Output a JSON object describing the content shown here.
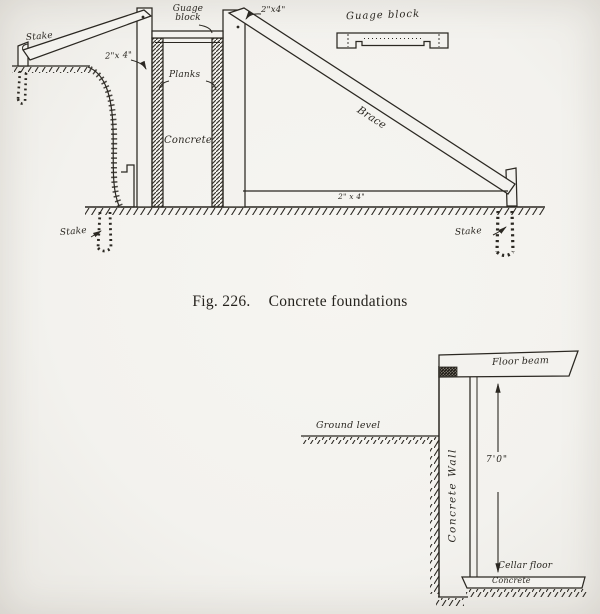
{
  "colors": {
    "paper": "#f3f2ee",
    "ink": "#2b2822"
  },
  "caption": {
    "fig_label": "Fig. 226.",
    "title": "Concrete foundations"
  },
  "top_diagram": {
    "description": "Concrete foundation formwork section",
    "labels": {
      "stake_top_left": "Stake",
      "two_by_four_left": "2\"x 4\"",
      "gauge_block": "Guage block",
      "two_by_four_right": "2\"x4\"",
      "planks": "Planks",
      "concrete": "Concrete",
      "brace": "Brace",
      "two_by_four_bottom": "2\" x 4\"",
      "stake_bottom_left": "Stake",
      "stake_bottom_right": "Stake",
      "gauge_block_detail": "Guage block"
    }
  },
  "bottom_diagram": {
    "description": "Concrete cellar wall section",
    "labels": {
      "ground_level": "Ground level",
      "floor_beam": "Floor beam",
      "concrete_wall": "Concrete Wall",
      "height_dimension": "7'0\"",
      "cellar_floor": "Cellar floor",
      "concrete": "Concrete"
    }
  }
}
